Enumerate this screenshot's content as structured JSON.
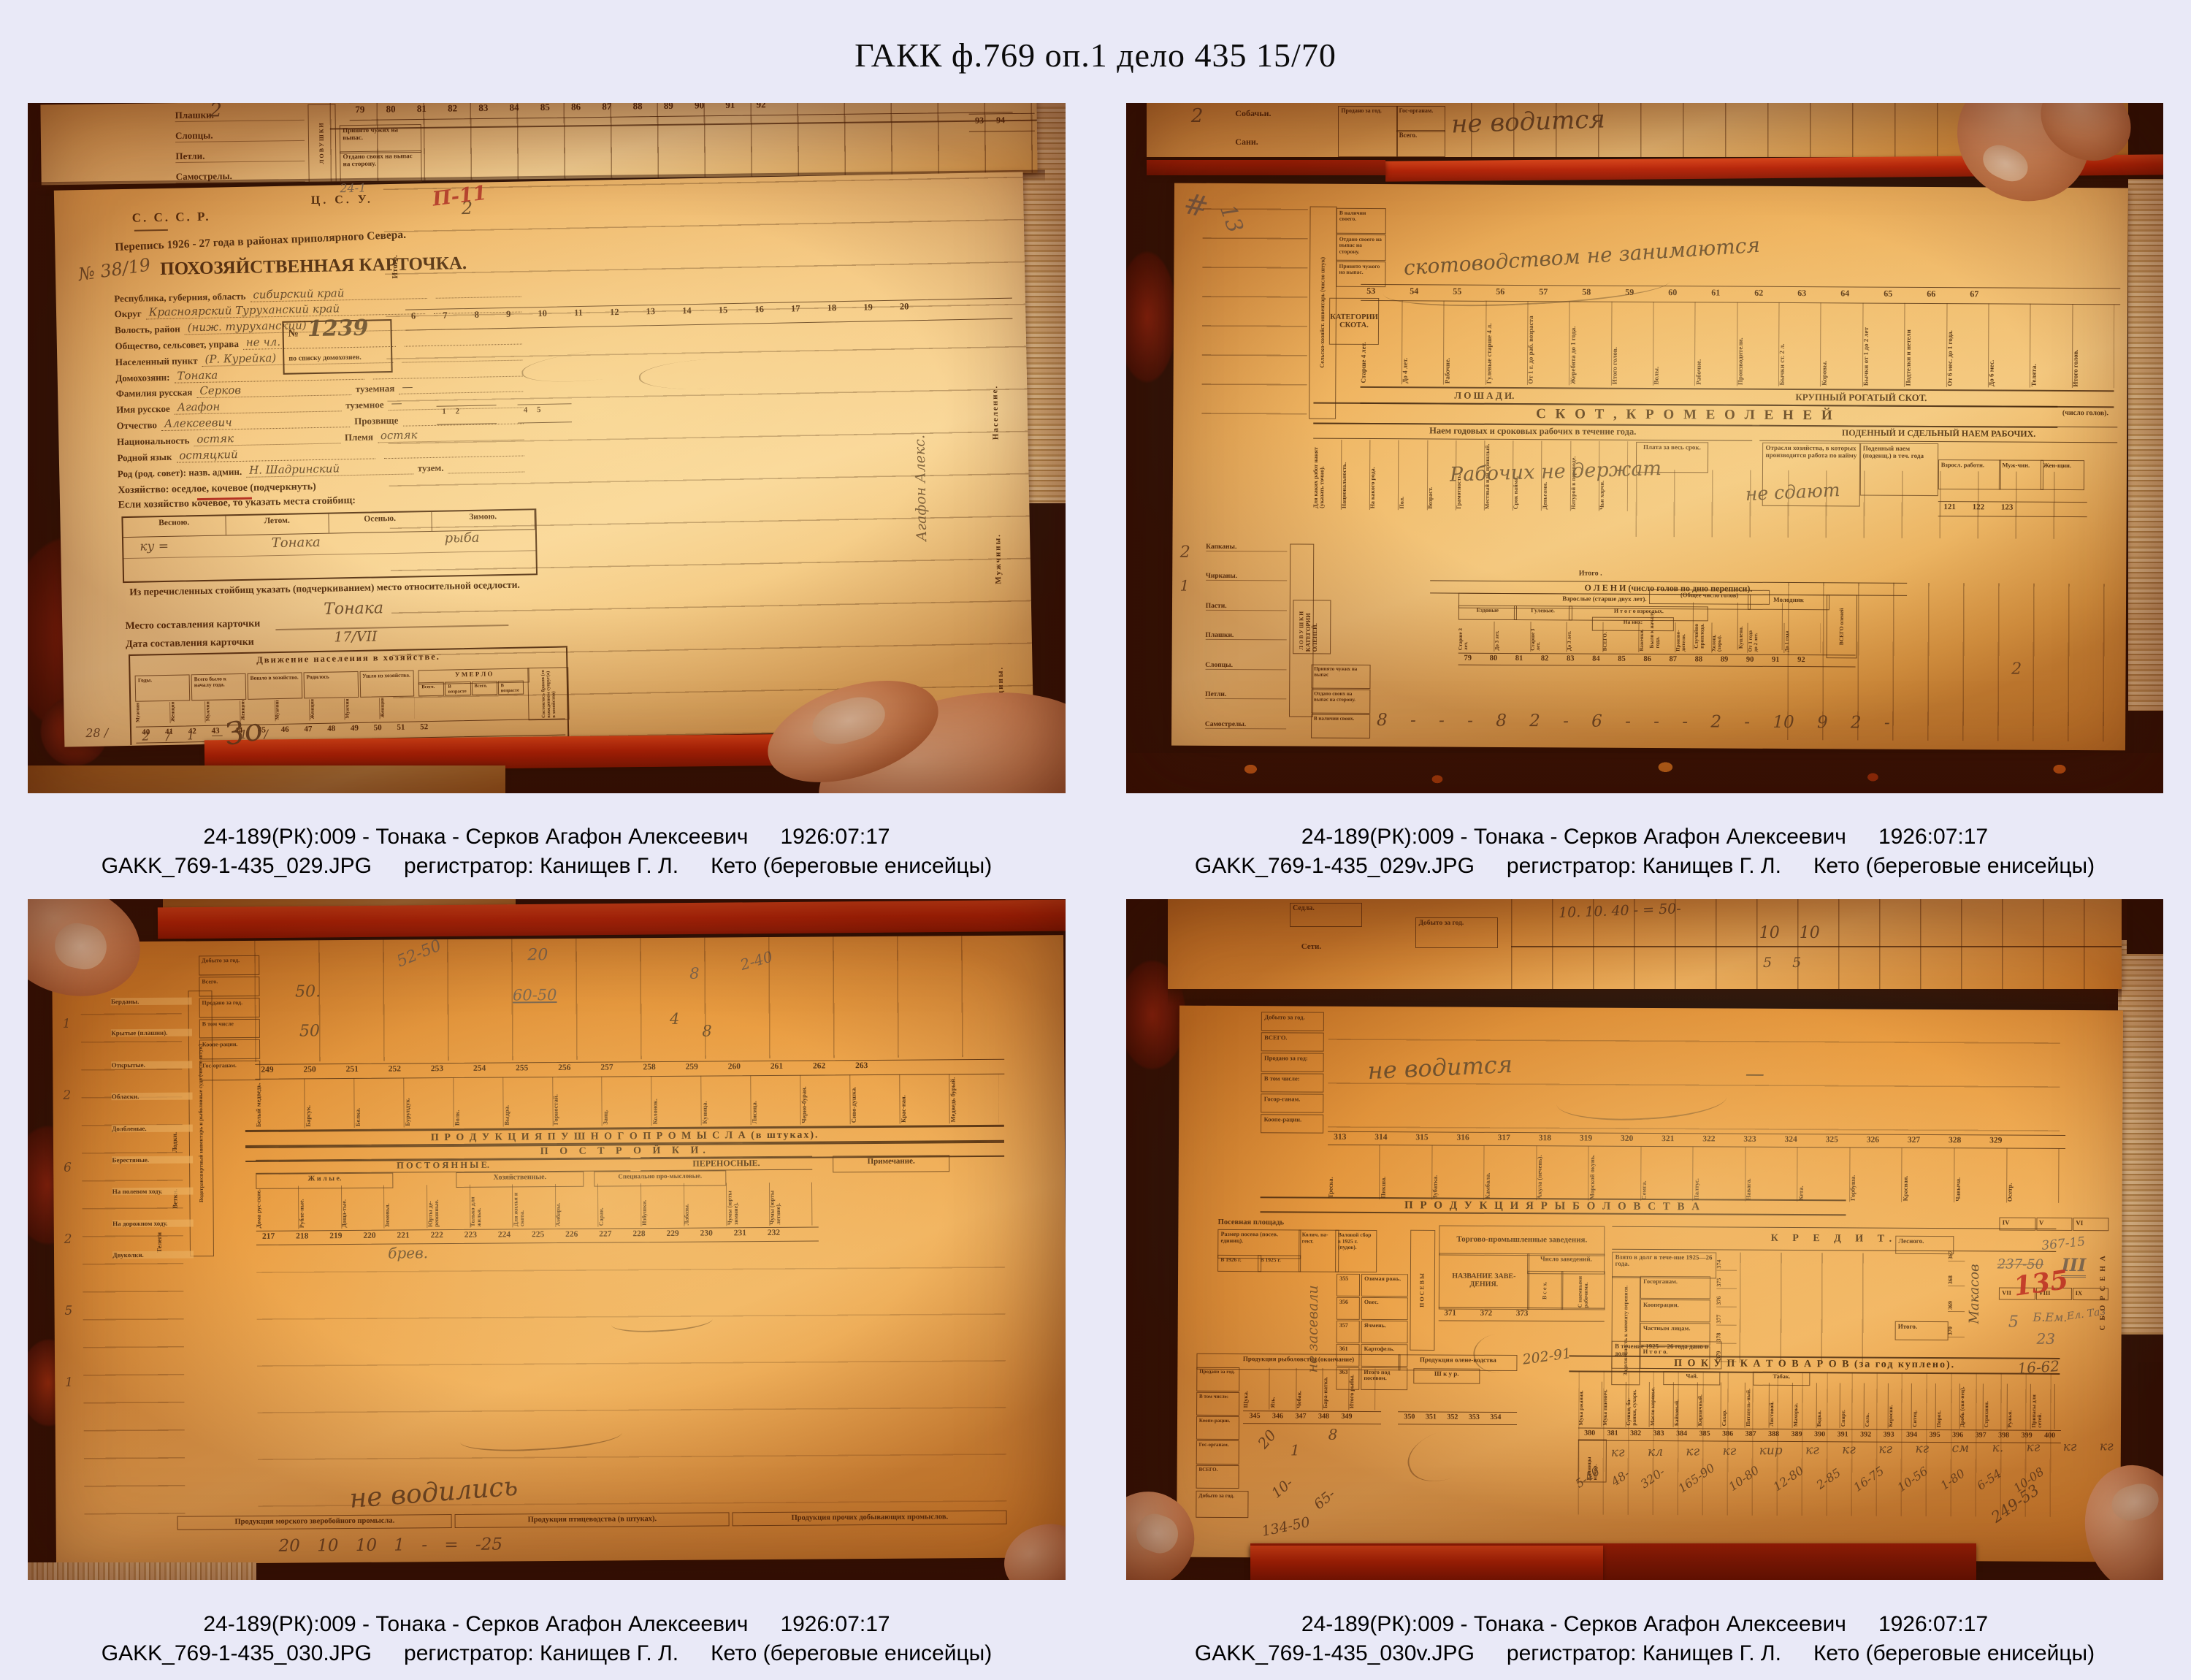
{
  "page": {
    "title": "ГАКК ф.769 оп.1 дело 435 15/70"
  },
  "photos": [
    {
      "caption": {
        "record": "24-189(РК):009 - Тонака - Серков Агафон Алексеевич",
        "date": "1926:07:17",
        "filename": "GAKK_769-1-435_029.JPG",
        "registrar": "регистратор: Канищев Г. Л.",
        "group": "Кето (береговые енисейцы)"
      },
      "doc": {
        "strip": {
          "numbers": "79  80  81  82  83  84  85  86  87  88  89  90  91  92",
          "numbers2": "93  94",
          "rows": [
            "Плашки.",
            "Слопцы.",
            "Петли.",
            "Самострелы."
          ],
          "vert": "Л О В У Ш К И",
          "cell1": "Принято чужих на выпас.",
          "cell2": "Отдано своих на выпас на сторону.",
          "hw": "2"
        },
        "card": {
          "cccp": "С. С. С. Р.",
          "csu": "Ц. С. У.",
          "census": "Перепись 1926 - 27 года в районах приполярного Севера.",
          "card_no": "№ 38/19",
          "card_title": "ПОХОЗЯЙСТВЕННАЯ КАРТОЧКА.",
          "red_mark": "П-11",
          "pencil": "24-1",
          "itogo": "Итого.",
          "hw_two": "2",
          "fields": [
            {
              "label": "Республика, губерния, область",
              "value": "сибирский край"
            },
            {
              "label": "Округ",
              "value": "Красноярский    Туруханский край"
            },
            {
              "label": "Волость, район",
              "value": "(ниж. туруханский)"
            },
            {
              "label": "Общество, сельсовет, управа",
              "value": "не чл."
            },
            {
              "label": "Населенный пункт",
              "value": "(Р. Курейка)"
            },
            {
              "label": "Домохозяин:",
              "value": "Тонака"
            },
            {
              "label": "Фамилия русская",
              "value": "Серков",
              "label2": "туземная",
              "value2": "—"
            },
            {
              "label": "Имя русское",
              "value": "Агафон",
              "label2": "туземное",
              "value2": "—"
            },
            {
              "label": "Отчество",
              "value": "Алексеевич",
              "label2": "Прозвище",
              "value2": ""
            },
            {
              "label": "Национальность",
              "value": "остяк",
              "label2": "Племя",
              "value2": "остяк"
            },
            {
              "label": "Родной язык",
              "value": "остяцкий"
            },
            {
              "label": "Род (род. совет): назв. админ.",
              "value": "Н. Шадринский",
              "label2": "тузем.",
              "value2": ""
            }
          ],
          "box": {
            "no": "№",
            "num": "1239",
            "label": "по списку домохозяев."
          },
          "household": "Хозяйство: оседлое, кочевое (подчеркнуть)",
          "camps": "Если хозяйство кочевое, то указать места стойбищ:",
          "seasons": [
            "Весною.",
            "Летом.",
            "Осенью.",
            "Зимою."
          ],
          "season_hw1": "ку =",
          "season_hw2": "Тонака",
          "season_hw3": "рыба",
          "settled": "Из перечисленных стойбищ указать (подчеркиванием) место относительной оседлости.",
          "settled_hw": "Тонака",
          "place_label": "Место составления карточки",
          "date_label": "Дата составления карточки",
          "date_hw": "17/VII",
          "mv_title": "Движение населения в хозяйстве.",
          "mv_cols": [
            "Годы.",
            "Всего было к началу года.",
            "Вошло в хозяйство.",
            "Родилось",
            "Ушло из хозяйства."
          ],
          "mv_umerlo": "У М Е Р Л О",
          "mv_minis": [
            "Мужчин.",
            "Женщин.",
            "Мужчин.",
            "Женщин.",
            "Мужчин.",
            "Женщин.",
            "Мужчин.",
            "Женщин."
          ],
          "mv_sub": [
            "Всего.",
            "В возрасте до 1 г.",
            "Всего.",
            "В возрасте до 1 г."
          ],
          "mv_wed": "Состоялось браков (со вхождением супруг(а) в хозяйство)",
          "mv_nums": "40  41  42  43  44  45  46  47  48  49  50  51  52",
          "mv_hw": "2 /  1  —  1 /",
          "mv_hw2": "28 /",
          "rnums": "6  7  8  9  10  11  12  13  14  15  16  17  18  19  20",
          "rnums2": "1   2",
          "rnums3": "4   5",
          "vert1": "Население.",
          "vert2": "Мужчины.",
          "vert3": "Женщины.",
          "hw_vert": "Агафон Алекс.",
          "hw_zo": "Зо"
        }
      }
    },
    {
      "caption": {
        "record": "24-189(РК):009 - Тонака - Серков Агафон Алексеевич",
        "date": "1926:07:17",
        "filename": "GAKK_769-1-435_029v.JPG",
        "registrar": "регистратор: Канищев Г. Л.",
        "group": "Кето (береговые енисейцы)"
      },
      "doc": {
        "strip": {
          "hw": "не водится",
          "rows": [
            "Собачьи.",
            "Сани."
          ],
          "cells": [
            "Продано за год.",
            "Гос-органам.",
            "Всего."
          ],
          "num": "2"
        },
        "pencil1": "#",
        "pencil2": "13",
        "inv_band": "Сельско-хозяйст. инвентарь (число штук)",
        "heads": [
          "В наличии своего.",
          "Отдано своего на выпас на сторону.",
          "Принято чужого на выпас."
        ],
        "cat_skota": "КАТЕГОРИИ СКОТА.",
        "hw1": "скотоводством не занимаются",
        "nums1": "53  54  55  56  57  58  59  60  61  62  63  64  65  66  67",
        "rot1": [
          "Старше 4 лет.",
          "До 4 лет.",
          "Рабочие.",
          "Гулевые старше 4 л.",
          "От 1 г. до раб. возраста",
          "Жеребята до 1 года.",
          "Итого голов.",
          "Волы.",
          "Рабочие.",
          "Производители.",
          "Бычки ст. 2 л.",
          "Коровы.",
          "Бычки от 1 до 2 лет",
          "Подтелки и нетели",
          "От 6 мес. до 1 года.",
          "До 6 мес.",
          "Телята.",
          "Итого голов."
        ],
        "band_l": "Л О Ш А Д И.",
        "band_r": "КРУПНЫЙ  РОГАТЫЙ  СКОТ.",
        "skot": "С К О Т ,      К Р О М Е      О Л Е Н Е Й",
        "skot2": "(число голов).",
        "naem": "Наем годовых и сроковых рабочих в течение года.",
        "podenny": "ПОДЕННЫЙ И СДЕЛЬНЫЙ НАЕМ РАБОЧИХ.",
        "rot2": [
          "Для каких работ нанят (указать точно).",
          "Национальность.",
          "На какого рода.",
          "Пол.",
          "Возраст.",
          "Грамотность.",
          "Местный или пришлый.",
          "Срок найма.",
          "Деньгами.",
          "Натурой в переводе.",
          "Чьи харчи."
        ],
        "plata": "Плата за весь срок.",
        "otrasli": "Отрасли хозяйства, в которых производится работа по найму",
        "poden2": "Поденный наем (поденщ.) в теч. года",
        "vzrosl": "Взросл. работн.",
        "muj": "Муж-чин.",
        "jen": "Жен-щин.",
        "nums2": "121   122   123",
        "hw2": "Рабочих не держат",
        "hw3": "не сдают",
        "oleni": {
          "band": "О Л Е Н И      (число голов по дню переписи).",
          "head1": "Взрослые (старше двух лет).",
          "head2": "Молодняк",
          "head3": "ВСЕГО оленей",
          "ezd": "Ездовые",
          "gul": "Гулевые.",
          "itogovz": "И т о г о   взрослых.",
          "iznih": "На них:",
          "minis": [
            "Старше 3 лет.",
            "До 3 лет.",
            "Старше 3 лет.",
            "До 3 лет.",
            "ВСЕГО.",
            "Важенки.",
            "Произво-дители.",
            "Холощ. (хоры).",
            "От 1 года до 2 лет.",
            "До 1 года"
          ],
          "cat": "КАТЕГОРИИ ОЛЕНЕЙ.",
          "nums": "79  80  81  82  83  84  85  86  87  88  89  90  91  92",
          "left": [
            "Принято чужих на выпас",
            "Отдано своих на выпас на сторону.",
            "В наличии своих."
          ],
          "hwrow": "8  -  -  -  8  2  -  6  -  -  -  2  -  10  9  2  -"
        },
        "traps": {
          "rows": [
            "Капканы.",
            "Чирканы.",
            "Пасти.",
            "Плашки.",
            "Слопцы.",
            "Петли.",
            "Самострелы."
          ],
          "band": "Л О В У Ш К И",
          "hw1": "2",
          "hw2": "1"
        },
        "itogo": "Итого .",
        "right_head": "(Общее число голов)",
        "right_cells": [
          "Было к началу года.",
          "Случайно приплода.",
          "Куплено."
        ]
      }
    },
    {
      "caption": {
        "record": "24-189(РК):009 - Тонака - Серков Агафон Алексеевич",
        "date": "1926:07:17",
        "filename": "GAKK_769-1-435_030.JPG",
        "registrar": "регистратор: Канищев Г. Л.",
        "group": "Кето (береговые енисейцы)"
      },
      "doc": {
        "hw_a": "52-50",
        "hw_b": "20",
        "hw_c": "60-50",
        "hw_d": "8",
        "hw_e": "2-40",
        "hw_f": "50.",
        "hw_g": "50",
        "hw_h": "4",
        "hw_i": "8",
        "cellsL": [
          "Добыто за год.",
          "Всего.",
          "Продано за год.",
          "В том числе",
          "Коопе-рации.",
          "Гос-органам."
        ],
        "left_rows": [
          "Берданы.",
          "Крытые (плашни).",
          "Открытые.",
          "Обласки.",
          "Долбленые.",
          "Берестяные.",
          "На полевом ходу.",
          "На дорожном ходу.",
          "Двуколки."
        ],
        "left_band": "Водотранспортный инвентарь и рыболовные суда (число штук)",
        "left_v1": "Лодки.",
        "left_v2": "Ветки.",
        "left_v3": "Телеги",
        "lefthw": [
          "1",
          "2",
          "6",
          "2",
          "5",
          "1"
        ],
        "nums1": "249  250  251  252  253  254  255  256  257  258  259  260  261  262  263",
        "rot1": [
          "Белый медведь.",
          "Барсук.",
          "Белка.",
          "Бурундук.",
          "Волк.",
          "Выдра.",
          "Горностай.",
          "Заяц.",
          "Колонок.",
          "Куница.",
          "Лисица.",
          "Черно-бурая.",
          "Сиво-душка.",
          "Крас-ная.",
          "Медведь бурый."
        ],
        "band1": "П Р О Д У К Ц И Я      П У Ш Н О Г О      П Р О М Ы С Л А      (в штуках).",
        "band2": "П О С Т Р О Й К И.",
        "band3": "П О С Т О Я Н Н Ы Е.",
        "band3b": "ПЕРЕНОСНЫЕ.",
        "prim": "Примечание.",
        "sub1": "Ж и л ы е.",
        "sub2": "Хозяйственные.",
        "sub3": "Специально про-мысловые.",
        "rot2": [
          "Дома рус-ские.",
          "Рубле-ные.",
          "Доща-тые.",
          "Зимовья.",
          "Юрты де-ревянные.",
          "Только для жилья.",
          "Для жилья и скота.",
          "Амбары.",
          "Сараи.",
          "Избушки.",
          "Лабазы.",
          "Чумы (юрты зимние).",
          "Чумы (юрты летние)."
        ],
        "nums2": "217  218  219  220  221  222  223  224  225  226  227  228  229  230  231  232",
        "bands_bottom": [
          "Продукция морского зверобойного промысла.",
          "Продукция птицеводства (в штуках).",
          "Продукция прочих добывающих промыслов."
        ],
        "hw_big": "не водились",
        "hw_row": "20 10 10 1   -   =   -25",
        "hw_mid": "брев."
      }
    },
    {
      "caption": {
        "record": "24-189(РК):009 - Тонака - Серков Агафон Алексеевич",
        "date": "1926:07:17",
        "filename": "GAKK_769-1-435_030v.JPG",
        "registrar": "регистратор: Канищев Г. Л.",
        "group": "Кето (береговые енисейцы)"
      },
      "doc": {
        "strip": {
          "sedla": "Седла.",
          "seti": "Сети.",
          "dob": "Добыто за год.",
          "hw": "10   10",
          "hw2": "5    5",
          "hw3": "10. 10. 40 -    = 50-"
        },
        "cellsM": [
          "Добыто за год.",
          "ВСЕГО.",
          "Продано за год:",
          "В том числе:",
          "Госор-ганам.",
          "Коопе-рации."
        ],
        "hw1": "не водится",
        "hw1b": "—",
        "nums1": "313  314  315  316  317  318  319  320  321  322  323  324  325  326  327  328  329",
        "rot1": [
          "Треска.",
          "Пикша.",
          "Зубатка.",
          "Камбала.",
          "Акула (печень).",
          "Морской окунь.",
          "Семга.",
          "Палтус.",
          "Навага.",
          "Кета.",
          "Горбуша.",
          "Красная.",
          "Чавыча.",
          "Осетр."
        ],
        "band1": "П Р О Д У К Ц И Я      Р Ы Б О Л О В С Т В А",
        "sown": {
          "head": "Посевная площадь",
          "size": "Размер посева (посев. единиц).",
          "y1": "В 1926 г.",
          "y2": "В 1925 г.",
          "kol": "Колич. на-гект.",
          "val": "Валовой сбор в 1925 г. (пудов).",
          "hw": "не засевали",
          "vert": "П О С Е В Ы"
        },
        "crops": [
          {
            "n": "355",
            "t": "Озимая рожь."
          },
          {
            "n": "356",
            "t": "Овес."
          },
          {
            "n": "357",
            "t": "Ячмень."
          },
          {
            "n": "361",
            "t": "Картофель."
          },
          {
            "n": "363",
            "t": "Итого под посевом."
          }
        ],
        "trade": {
          "head": "Торгово-промышленные заведения.",
          "name": "НАЗВАНИЕ ЗАВЕ-ДЕНИЯ.",
          "num": "Число заведений.",
          "vseh": "В с е х.",
          "naem": "С наемными рабочими.",
          "nums": "371        372        373"
        },
        "credit": {
          "head": "К  Р  Е  Д  И  Т.",
          "vzjato": "Взято в долг в тече-ние 1925—26 года.",
          "zadol": "Задолженность к моменту переписи.",
          "rows": [
            "Госорганам.",
            "Кооперации.",
            "Частным лицам.",
            "И т о г о."
          ],
          "dano": "В течение 1925— 26 года дано в долг",
          "nums": [
            "374",
            "375",
            "376",
            "377",
            "378",
            "379"
          ],
          "roman1": [
            "IV",
            "V",
            "VI"
          ],
          "roman2": [
            "VII",
            "VIII",
            "IX"
          ],
          "hw1": "367-15",
          "hw2": "237-50",
          "hw3": "III",
          "hw4": "5",
          "hw5": "Б.Ем.",
          "hw6": "23",
          "hw7": "Ел. Таз"
        },
        "sena": {
          "vert": "С Б О Р    С Е Н А",
          "les": "Лесного.",
          "itogo": "Итого.",
          "nums": [
            "367",
            "368",
            "369",
            "370"
          ],
          "hw": "Макасов"
        },
        "red_mark": "135",
        "pok": {
          "band": "П О К У П К А       Т О В А Р О В       (за год куплено).",
          "hw1": "202-91",
          "hw2": "16-62",
          "chai": "Чай.",
          "tabak": "Табак.",
          "goods": [
            "Мука ржаная.",
            "Мука пшенич.",
            "Сушки, ба-ранки, сухари.",
            "Масло коровье.",
            "Байховый.",
            "Кирпичный.",
            "Сахар.",
            "Питатель-ный.",
            "Листовой.",
            "Махорка.",
            "Водка.",
            "Спирт.",
            "Соль.",
            "Керосин.",
            "Ситец.",
            "Порох.",
            "Дробь (сви-нец).",
            "Стрихнин.",
            "Ружья.",
            "Припасы для сетей."
          ],
          "nums": "380  381  382  383  384  385  386  387  388  389  390  391  392  393  394  395  396  397  398  399  400  401  402  403  404",
          "ed": "Единицы измер.",
          "units": "кг   кл   кг   кг   кир   кг   кг   кг   кг   см   к.   кг   кг   кг",
          "amounts": [
            "5-40",
            "48-",
            "320-",
            "165-90",
            "10-80",
            "12-80",
            "2-85",
            "16-75",
            "10-56",
            "1-80",
            "6-54",
            "10-08"
          ],
          "total": "249-53"
        },
        "fish2": {
          "head1": "Продукция рыболовства (окончание)",
          "head2": "Продукция олене-водства",
          "shkur": "Ш к у р.",
          "rot": [
            "Щука.",
            "Язь.",
            "Чебак.",
            "Бара-натка.",
            "Итого рыбы."
          ],
          "nums1": "345  346  347  348  349",
          "nums2": "350  351  352  353  354",
          "left": [
            "Продано за год.",
            "В том числе:",
            "Коопе-рации.",
            "Гос-органам.",
            "ВСЕГО."
          ],
          "dob": "Добыто за год.",
          "hw_1": "20",
          "hw_2": "1",
          "hw_3": "8",
          "hw_4": "10-",
          "hw_5": "65-",
          "hw_6": "134-50"
        }
      }
    }
  ]
}
